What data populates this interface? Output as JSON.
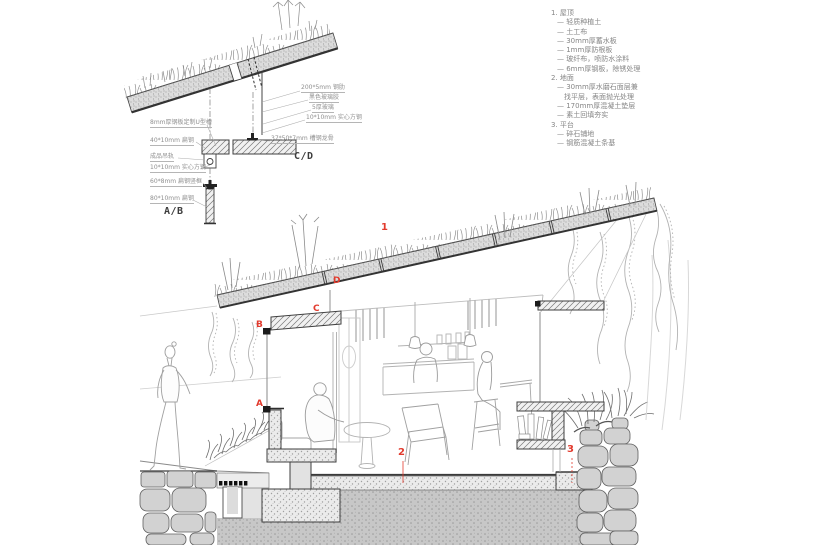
{
  "legend": {
    "lines": [
      "1. 屋顶",
      "— 轻质种植土",
      "— 土工布",
      "— 30mm厚蓄水板",
      "— 1mm厚防根板",
      "— 玻纤布，喷防水涂料",
      "— 6mm厚钢板，除锈处理",
      "2. 地面",
      "— 30mm厚水磨石面层兼",
      "找平层，表面抛光处理",
      "— 170mm厚混凝土垫层",
      "— 素土回填夯实",
      "3. 平台",
      "— 碎石铺地",
      "— 钢筋混凝土条基"
    ]
  },
  "details": {
    "left_labels": [
      "8mm厚钢板定制U型槽",
      "40*10mm 扁钢",
      "成品吊轨",
      "10*10mm 实心方钢",
      "60*8mm 扁钢竖框",
      "80*10mm 扁钢"
    ],
    "right_labels": [
      "200*5mm 钢肋",
      "黑色玻璃胶",
      "5厚玻璃",
      "10*10mm 实心方钢",
      "37*50*7mm 槽钢龙骨"
    ],
    "captions": {
      "ab": "A/B",
      "cd": "C/D"
    }
  },
  "markers": {
    "m1": "1",
    "m2": "2",
    "m3": "3",
    "ma": "A",
    "mb": "B",
    "mc": "C",
    "md": "D"
  },
  "colors": {
    "marker_red": "#e23b2e",
    "cut_outline": "#3f3f3f",
    "sketch_grey": "#a6a6a6"
  }
}
